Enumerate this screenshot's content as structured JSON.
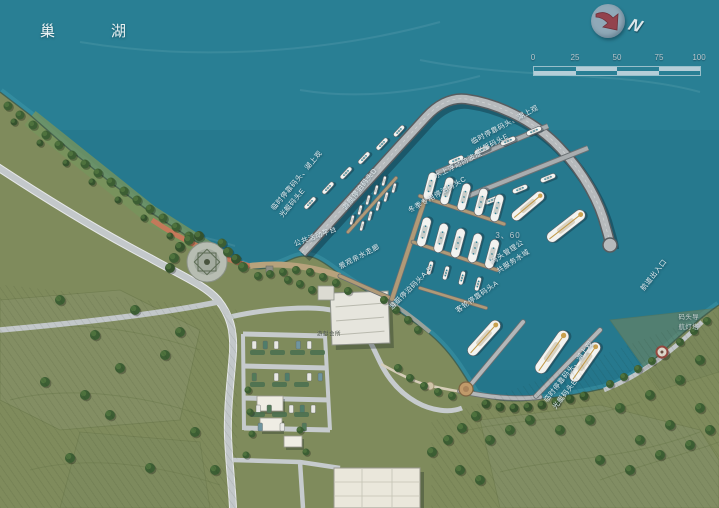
{
  "lake": {
    "name": "巢湖"
  },
  "compass": {
    "north_label": "N"
  },
  "scale_bar": {
    "ticks": [
      "0",
      "25",
      "50",
      "75",
      "100"
    ]
  },
  "labels": {
    "berth_e": "临时停靠码头、湖上观\n光艇码头E",
    "floating_breakwater": "水上浮动防波堤",
    "dock_d": "游艇停泊码头D",
    "dock_c": "冬季专用停泊码头C",
    "public_platform": "公共活动平台",
    "waterfront_corridor": "景观亲水走廊",
    "dock_ab": "游艇停泊码头A.B",
    "passenger_dock_a": "客轮停靠码头A",
    "depth_note": "3、60",
    "management_water": "码头管理公\n共服务水域",
    "channel_entrance": "航道出入口",
    "lighthouse_beacon": "码头导航灯塔",
    "clubhouse": "游艇会所"
  }
}
